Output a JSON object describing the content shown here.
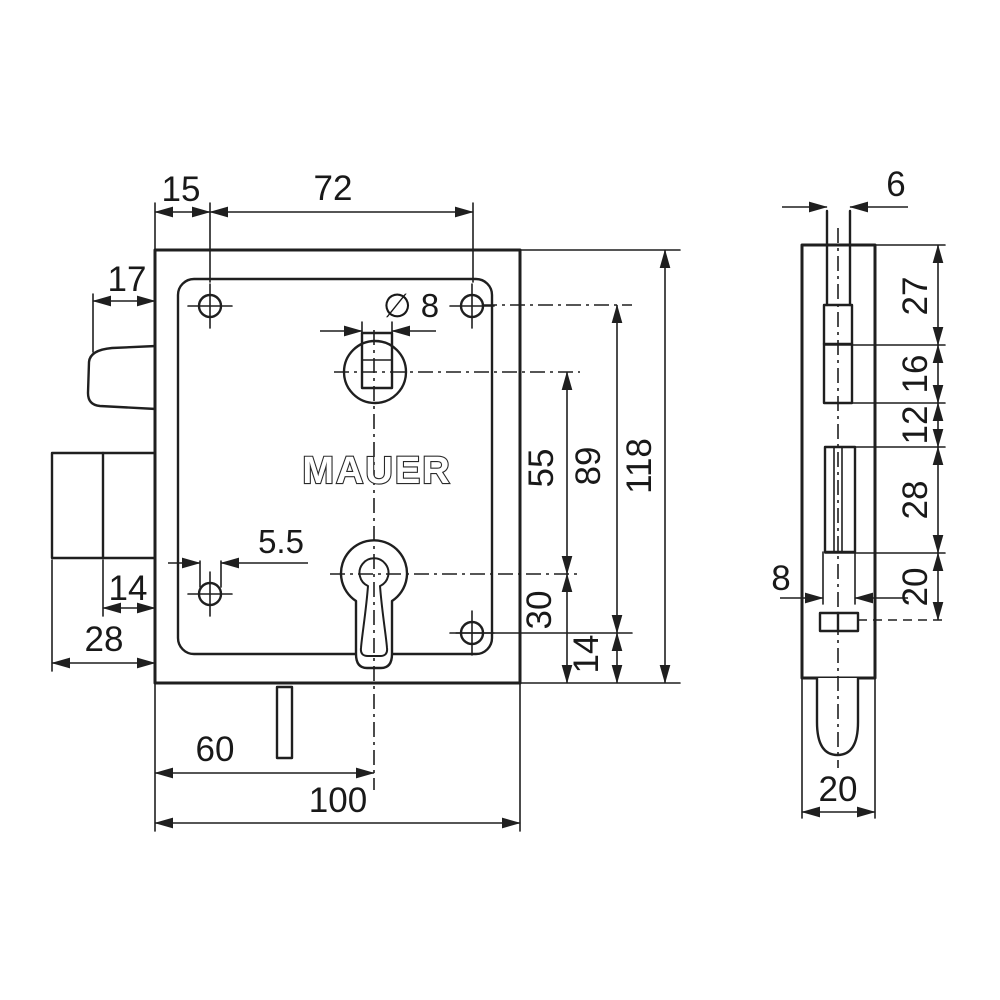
{
  "drawing": {
    "brand": "MAUER",
    "front_view": {
      "plate_top_offset": "15",
      "screw_spacing_h": "72",
      "latch_width": "17",
      "hub_hole": "∅ 8",
      "screw_hole_dia": "5.5",
      "bolt_throw": "14",
      "bolt_block_width": "28",
      "key_center_x": "60",
      "plate_width": "100",
      "hub_to_key": "55",
      "key_to_bottom": "30",
      "screw_span_v": "89",
      "screw_bottom_offset": "14",
      "plate_height": "118"
    },
    "side_view": {
      "faceplate_width": "6",
      "seg_top": "27",
      "seg_latch": "16",
      "seg_mid": "12",
      "seg_key": "28",
      "seg_lower": "20",
      "channel_width": "8",
      "case_depth": "20"
    }
  }
}
